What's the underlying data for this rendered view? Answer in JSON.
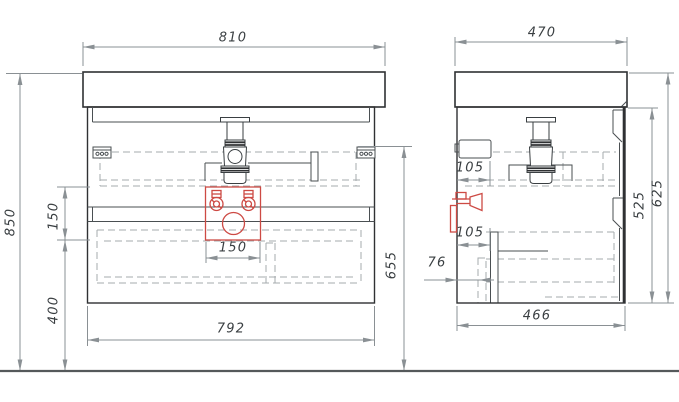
{
  "drawing": {
    "views": {
      "front": {
        "dims": {
          "top_width": "810",
          "total_height": "850",
          "zone_height": "150",
          "zone_width": "150",
          "zone_floor_offset": "400",
          "cabinet_width": "792",
          "bracket_height": "655"
        }
      },
      "side": {
        "dims": {
          "top_depth": "470",
          "upper_offset": "105",
          "lower_offset": "105",
          "back_offset": "76",
          "cabinet_depth": "466",
          "body_height": "525",
          "total_with_top": "625"
        }
      }
    },
    "colors": {
      "outline": "#2f3133",
      "hidden_line": "#a6abae",
      "dimension_line": "#8a9094",
      "text": "#3a3f42",
      "accent_red": "#cd4a44",
      "floor": "#55595b"
    }
  }
}
